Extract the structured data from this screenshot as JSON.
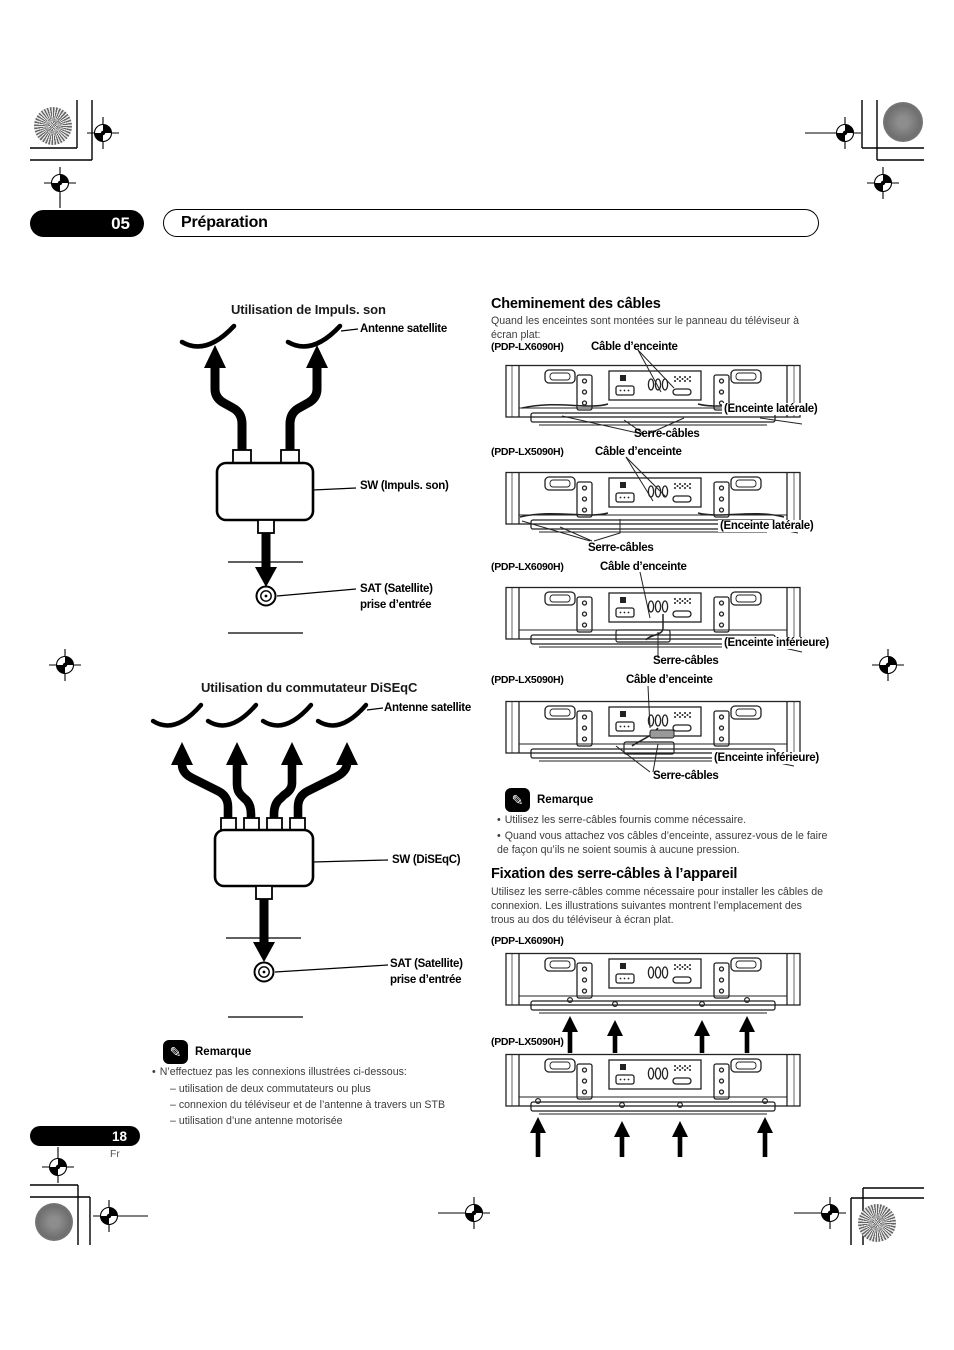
{
  "header": {
    "chapter_number": "05",
    "chapter_title": "Préparation"
  },
  "footer": {
    "page_number": "18",
    "page_lang": "Fr"
  },
  "left": {
    "diagram1": {
      "title": "Utilisation de Impuls. son",
      "antenna_label": "Antenne satellite",
      "sw_label": "SW (Impuls. son)",
      "sat_line1": "SAT (Satellite)",
      "sat_line2": "prise d’entrée"
    },
    "diagram2": {
      "title": "Utilisation du commutateur  DiSEqC",
      "antenna_label": "Antenne satellite",
      "sw_label": "SW (DiSEqC)",
      "sat_line1": "SAT (Satellite)",
      "sat_line2": "prise d’entrée"
    },
    "remarque": {
      "icon": "pencil-icon",
      "title": "Remarque",
      "bullet": "N’effectuez pas les connexions illustrées ci-dessous:",
      "items": [
        "– utilisation de deux commutateurs ou plus",
        "– connexion du téléviseur et de l’antenne à travers un STB",
        "– utilisation d’une antenne motorisée"
      ]
    }
  },
  "right": {
    "cheminement": {
      "heading": "Cheminement des câbles",
      "intro": "Quand les enceintes sont montées sur le panneau du téléviseur à écran plat:",
      "figures": [
        {
          "model": "(PDP-LX6090H)",
          "cable_label": "Câble d’enceinte",
          "speaker_label": "(Enceinte latérale)",
          "clamp_label": "Serre-câbles"
        },
        {
          "model": "(PDP-LX5090H)",
          "cable_label": "Câble d’enceinte",
          "speaker_label": "(Enceinte latérale)",
          "clamp_label": "Serre-câbles"
        },
        {
          "model": "(PDP-LX6090H)",
          "cable_label": "Câble d’enceinte",
          "speaker_label": "(Enceinte inférieure)",
          "clamp_label": "Serre-câbles"
        },
        {
          "model": "(PDP-LX5090H)",
          "cable_label": "Câble d’enceinte",
          "speaker_label": "(Enceinte inférieure)",
          "clamp_label": "Serre-câbles"
        }
      ],
      "remarque": {
        "icon": "pencil-icon",
        "title": "Remarque",
        "bullets": [
          "Utilisez les serre-câbles fournis comme nécessaire.",
          "Quand vous attachez vos câbles d’enceinte, assurez-vous de le faire de façon qu’ils ne soient soumis à aucune pression."
        ]
      }
    },
    "fixation": {
      "heading": "Fixation des serre-câbles à l’appareil",
      "intro": "Utilisez les serre-câbles comme nécessaire pour installer les câbles de connexion. Les illustrations suivantes montrent l’emplacement des trous au dos du téléviseur à écran plat.",
      "figures": [
        {
          "model": "(PDP-LX6090H)"
        },
        {
          "model": "(PDP-LX5090H)"
        }
      ]
    }
  }
}
